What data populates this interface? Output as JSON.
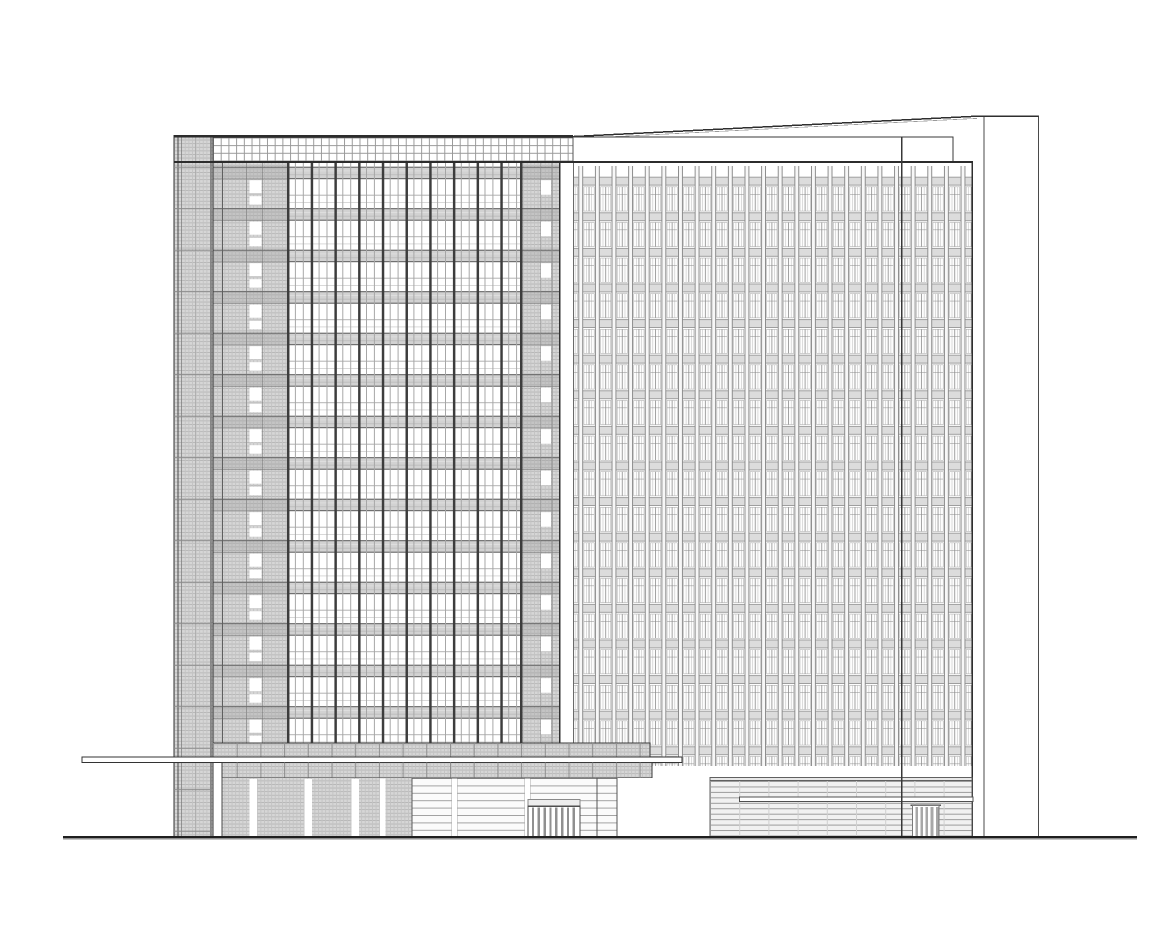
{
  "page": {
    "title": "Building Elevation Drawing",
    "kind": "architectural-elevation"
  },
  "drawing": {
    "colors": {
      "paper": "#ffffff",
      "ink": "#2c2c2c",
      "line-strong": "#3a3a3a",
      "line-mid": "#8a8a8a",
      "line-soft": "#b2b2b2",
      "hatch-fill": "#d6d6d6",
      "hatch-line": "#b6b6b6",
      "spandrel-left": "#d2d2d2",
      "spandrel-right": "#dcdcdc",
      "fin-face": "#f7f7f7",
      "louver-face": "#f1f1f1",
      "glass": "#ffffff"
    },
    "left_tower": {
      "floors": 14,
      "curtain_wall_bays": 10,
      "sub_lites_per_bay": 3,
      "roof_grid_band_rows": 4,
      "side_piers": 2,
      "window_slot_columns": 2
    },
    "right_wing": {
      "floors": 17,
      "fin_modules": 24,
      "windows_per_module": 2,
      "has_parapet": true,
      "has_sloped_roofline": true,
      "expansion_joint": true
    },
    "podium": {
      "storefront_bays": 3,
      "storefront_transoms": 8,
      "entrance_door_bars": 8,
      "louver_door_bars": 5,
      "has_canopy_slab": true,
      "has_louver_wall": true
    },
    "site": {
      "ground_line": true,
      "right_end_wall": true
    }
  }
}
